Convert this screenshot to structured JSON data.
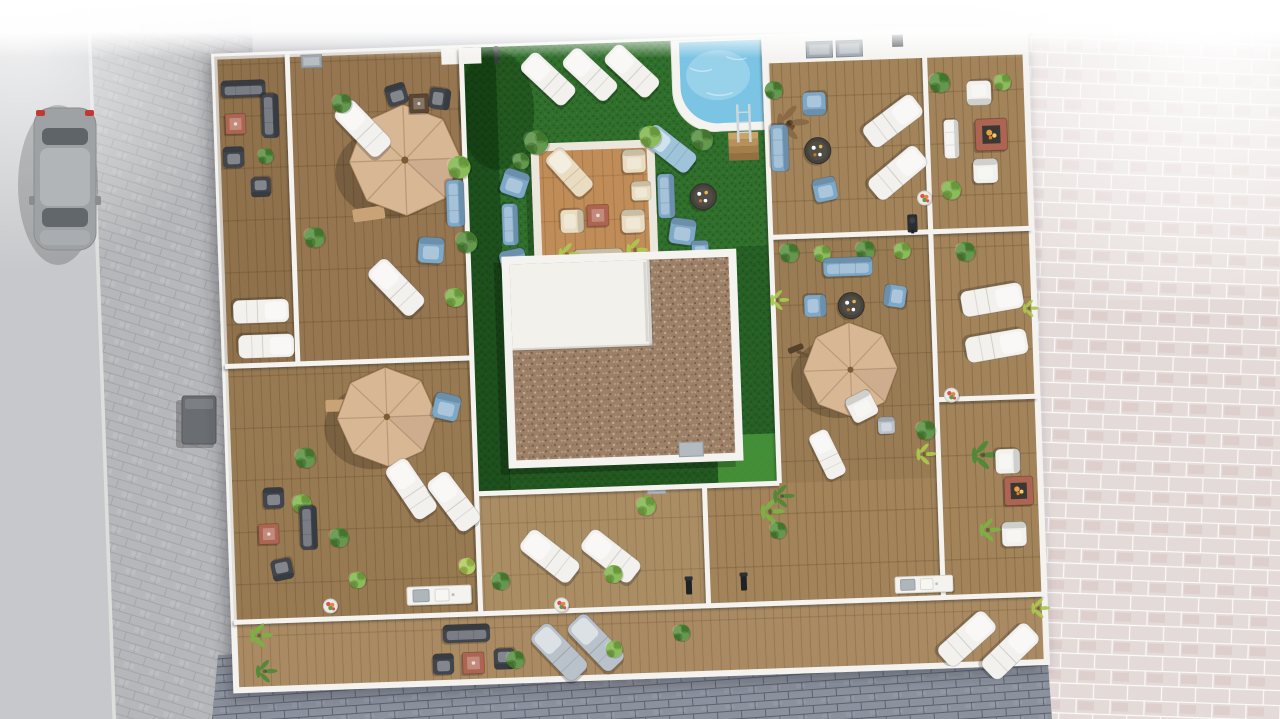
{
  "meta": {
    "title": "Aerial 3D architectural render of an apartment building rooftop with communal pool courtyard and private timber-deck terraces",
    "image_kind": "3d-render-top-down-view"
  },
  "palette": {
    "asphalt": "#c7c8cb",
    "cobble": "#b6b7ba",
    "cobble_dark": "#8b919d",
    "paver": "#e4dbd9",
    "wall": "#f4f3f0",
    "wood": "#a2835a",
    "platform": "#c08d58",
    "lawn": "#2f6e2b",
    "lawn_bright": "#49983b",
    "pool": "#7cc4e4",
    "gravel": "#9c8068",
    "umbrella": "#d8b795",
    "umbrella_frame": "#6b5234",
    "dark": "#41464e",
    "terracotta": "#ad6450",
    "blue": "#7ea8c8",
    "blue2": "#9fc4da",
    "cream": "#e9dcc0",
    "white_furn": "#f2f1ed",
    "grey_furn": "#b9c2cb",
    "plant": "#4e8a35",
    "plant_light": "#7ab344",
    "plant_yellow": "#aac94e",
    "plant_dark": "#2f6325",
    "plant_brown": "#8a6a45",
    "flame": "#e8a13c",
    "car": "#9fa2a5"
  },
  "scene": {
    "kind": "3D aerial architectural visualization",
    "subject": "Rooftop communal courtyard with swimming pool, artificial lawn, timber lounge platform and surrounding private terraces",
    "areas": [
      {
        "name": "street-left",
        "features": [
          "asphalt road",
          "parked grey car",
          "cobblestone sidewalk",
          "utility cabinet"
        ]
      },
      {
        "name": "communal-courtyard",
        "features": [
          "artificial lawn",
          "swimming pool with ladder and timber steps",
          "three sun loungers on lawn",
          "timber lounge platform with cream lounge set",
          "pebble-gravel roof core with white flat roof",
          "air-conditioning units",
          "outdoor shower post"
        ]
      },
      {
        "name": "private-terraces",
        "features": [
          "timber decking",
          "white parapet walls",
          "three tan cantilever parasols",
          "sun loungers",
          "dark rattan sofa sets with terracotta tables",
          "blue cushioned lounge groups",
          "fire-pit tables",
          "outdoor kitchen counters",
          "bollard lights",
          "shrubs and palms in planters"
        ]
      },
      {
        "name": "pavement-right",
        "features": [
          "pink stone pavers fading to white"
        ]
      },
      {
        "name": "pavement-bottom",
        "features": [
          "blue-grey cobblestone paving"
        ]
      }
    ],
    "object_counts": {
      "parasols": 3,
      "swimming_pools": 1,
      "sun_loungers": 21,
      "lounge_sofa_groups": 6,
      "fire_pit_tables": 3,
      "round_coffee_tables": 3,
      "terracotta_coffee_tables": 4,
      "outdoor_kitchen_counters": 2,
      "roof_skylights": 3,
      "bollard_lights": 2,
      "flower_pots": 4,
      "cars": 1,
      "air_conditioning_units": 2,
      "shrubs_and_palms": 44
    }
  }
}
